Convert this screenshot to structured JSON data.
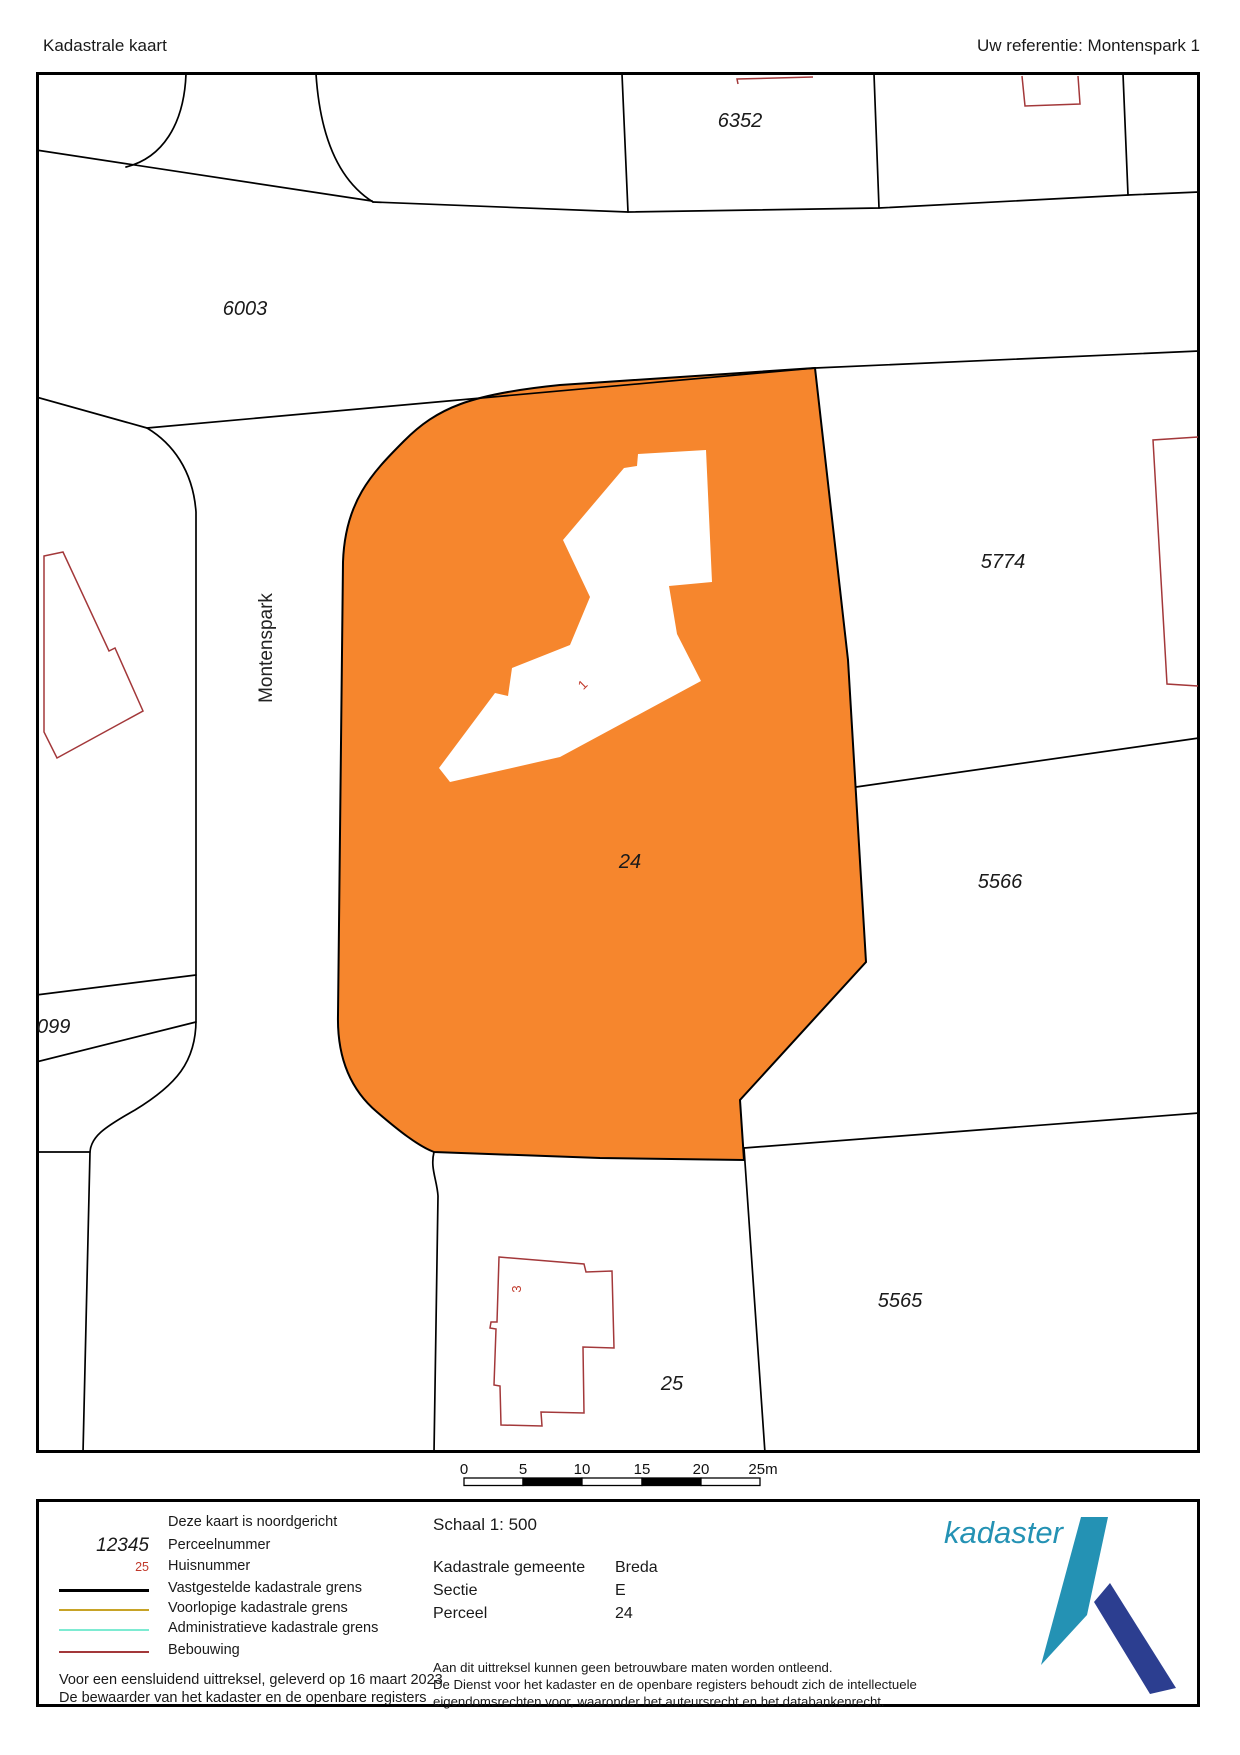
{
  "header": {
    "title": "Kadastrale kaart",
    "reference": "Uw referentie: Montenspark 1"
  },
  "map": {
    "parcel_numbers": [
      {
        "text": "6352"
      },
      {
        "text": "6003"
      },
      {
        "text": "5774"
      },
      {
        "text": "5566"
      },
      {
        "text": "5565"
      },
      {
        "text": "25"
      },
      {
        "text": "24"
      },
      {
        "text": "099"
      }
    ],
    "street_name": "Montenspark",
    "house_numbers": [
      {
        "text": "1"
      },
      {
        "text": "3"
      }
    ],
    "scale_bar": {
      "tick_labels": [
        "0",
        "5",
        "10",
        "15",
        "20",
        "25m"
      ]
    },
    "colors": {
      "selected_parcel_fill": "#F6862D",
      "kadastrale_grens": "#000000",
      "bebouwing_outline": "#A3383A",
      "huisnummer": "#C0392B"
    }
  },
  "legend": {
    "north_note": "Deze kaart is noordgericht",
    "items": [
      {
        "sample": "12345",
        "label": "Perceelnummer"
      },
      {
        "sample": "25",
        "label": "Huisnummer"
      },
      {
        "line_color": "#000000",
        "label": "Vastgestelde kadastrale grens"
      },
      {
        "line_color": "#C7A327",
        "label": "Voorlopige kadastrale grens"
      },
      {
        "line_color": "#7DEBD2",
        "label": "Administratieve kadastrale grens"
      },
      {
        "line_color": "#A3383A",
        "label": "Bebouwing"
      }
    ],
    "footnote_lines": [
      "Voor een eensluidend uittreksel, geleverd op 16 maart 2023",
      "De bewaarder van het kadaster en de openbare registers"
    ]
  },
  "details": {
    "scale": "Schaal 1: 500",
    "fields": [
      {
        "label": "Kadastrale gemeente",
        "value": "Breda"
      },
      {
        "label": "Sectie",
        "value": "E"
      },
      {
        "label": "Perceel",
        "value": "24"
      }
    ],
    "disclaimer_lines": [
      "Aan dit uittreksel kunnen geen betrouwbare maten worden ontleend.",
      "De Dienst voor het kadaster en de openbare registers behoudt zich de intellectuele",
      "eigendomsrechten voor, waaronder het auteursrecht en het databankenrecht."
    ]
  },
  "logo": {
    "text": "kadaster",
    "teal": "#2492B4",
    "navy": "#2C3E90"
  }
}
